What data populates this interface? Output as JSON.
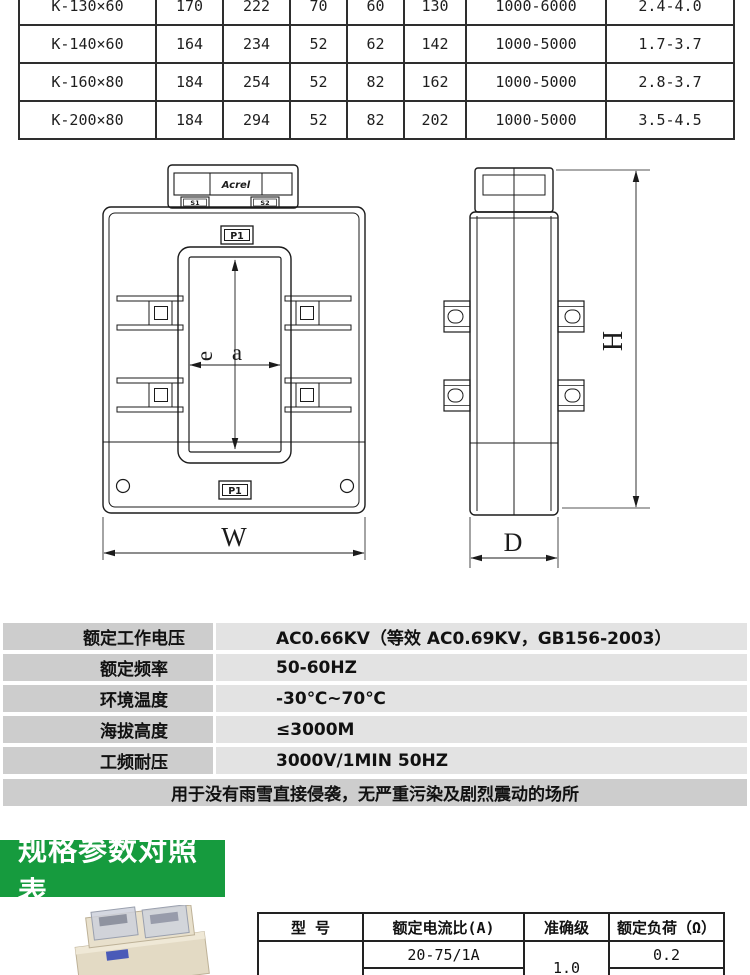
{
  "top_table": {
    "rows": [
      {
        "model": "K-130×60",
        "values": [
          "170",
          "222",
          "70",
          "60",
          "130",
          "1000-6000",
          "2.4-4.0"
        ]
      },
      {
        "model": "K-140×60",
        "values": [
          "164",
          "234",
          "52",
          "62",
          "142",
          "1000-5000",
          "1.7-3.7"
        ]
      },
      {
        "model": "K-160×80",
        "values": [
          "184",
          "254",
          "52",
          "82",
          "162",
          "1000-5000",
          "2.8-3.7"
        ]
      },
      {
        "model": "K-200×80",
        "values": [
          "184",
          "294",
          "52",
          "82",
          "202",
          "1000-5000",
          "3.5-4.5"
        ]
      }
    ]
  },
  "diagram": {
    "front_view": {
      "brand": "Acrel",
      "terminal_left": "S1",
      "terminal_right": "S2",
      "label_top": "P1",
      "label_bottom": "P1",
      "dim_inner_height": "e",
      "dim_inner_width": "a",
      "dim_width": "W"
    },
    "side_view": {
      "dim_height": "H",
      "dim_depth": "D"
    }
  },
  "spec_table": {
    "rows": [
      {
        "label": "额定工作电压",
        "value": "AC0.66KV（等效 AC0.69KV，GB156-2003）"
      },
      {
        "label": "额定频率",
        "value": "50-60HZ"
      },
      {
        "label": "环境温度",
        "value": "-30℃~70℃"
      },
      {
        "label": "海拔高度",
        "value": "≤3000M"
      },
      {
        "label": "工频耐压",
        "value": "3000V/1MIN 50HZ"
      }
    ],
    "note": "用于没有雨雪直接侵袭，无严重污染及剧烈震动的场所"
  },
  "section_banner": {
    "title": "规格参数对照表",
    "bg": "#169b3e"
  },
  "bottom_table": {
    "headers": [
      "型 号",
      "额定电流比(A)",
      "准确级",
      "额定负荷（Ω）"
    ],
    "accuracy_merged": "1.0",
    "rows": [
      {
        "model": "",
        "ratio": "20-75/1A",
        "burden": "0.2"
      },
      {
        "model": "",
        "ratio": "100-450/5(1)A",
        "burden": "1.0"
      }
    ]
  },
  "colors": {
    "banner_green": "#169b3e",
    "spec_label_bg": "#cdcdcd",
    "spec_value_bg": "#e3e3e3",
    "table_border": "#2e2e2e",
    "drawing_line": "#1b1b1b"
  }
}
